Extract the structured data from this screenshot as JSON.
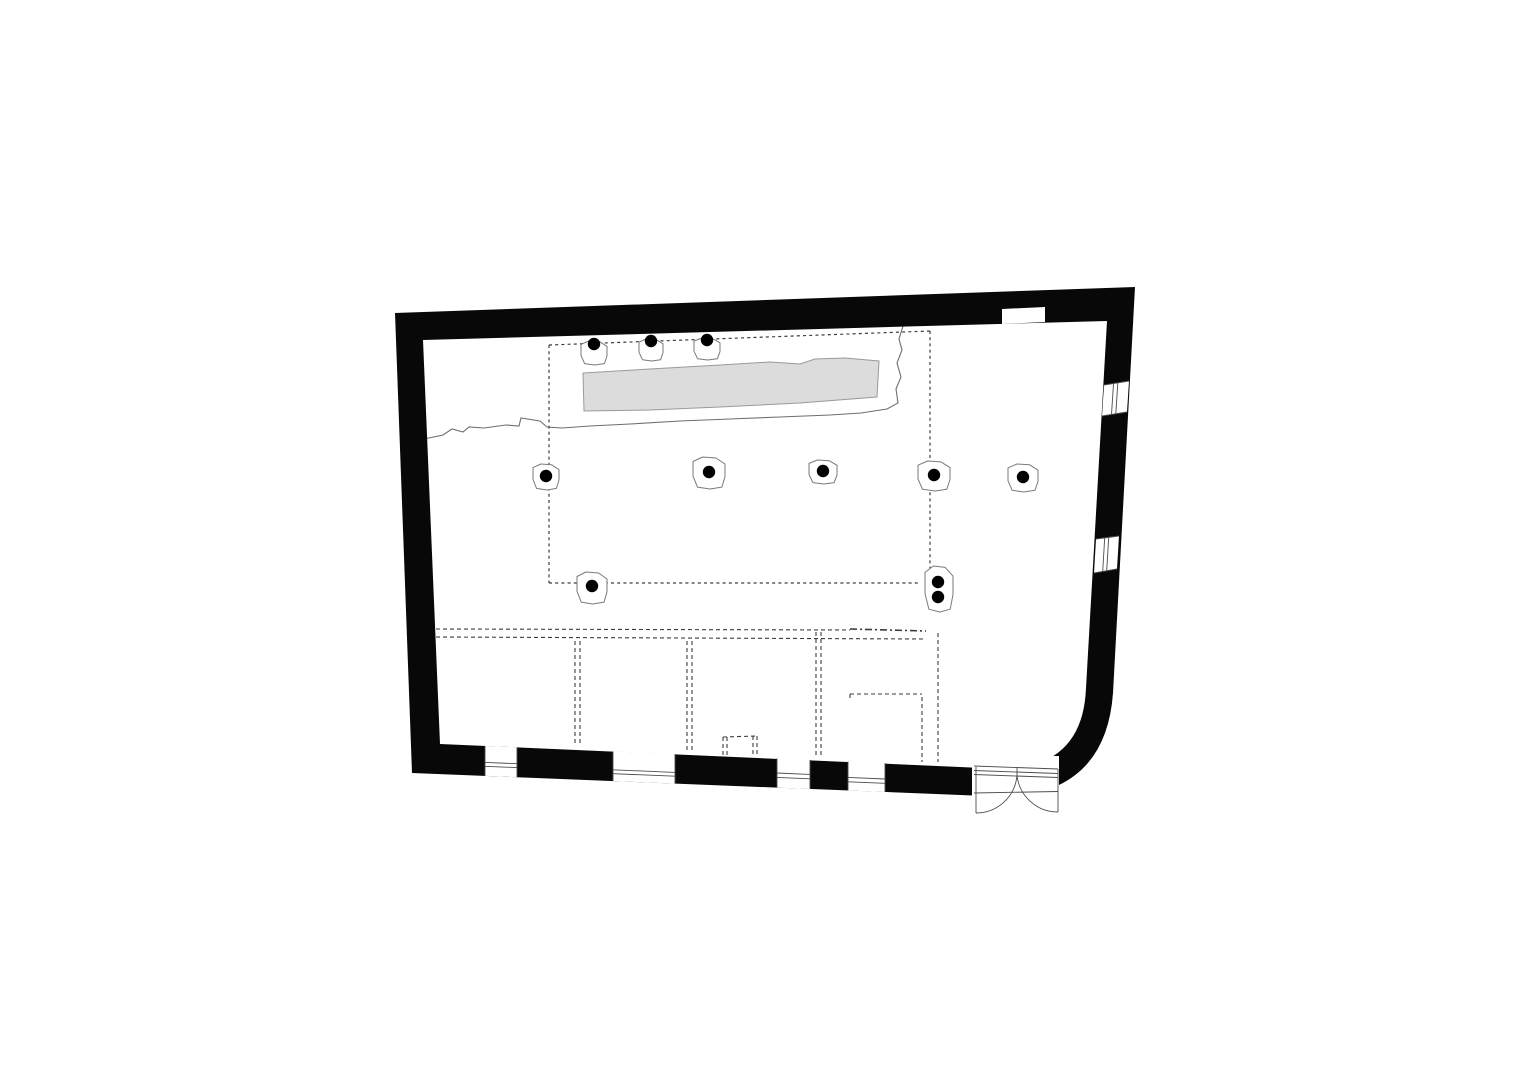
{
  "meta": {
    "kind": "architectural-floor-plan",
    "canvas": {
      "width": 1528,
      "height": 1080
    }
  },
  "colors": {
    "background": "#ffffff",
    "wall_fill": "#080808",
    "thin_line": "#4d4d4d",
    "survey_line": "#6e6e6e",
    "dash_line": "#3c3c3c",
    "paved_fill": "#dcdcdc",
    "paved_stroke": "#9a9a9a",
    "column_dot": "#000000",
    "column_base_stroke": "#7a7a7a",
    "column_base_fill": "#ffffff"
  },
  "walls": {
    "outer_path": "M395,313 L1135,287 L1113,693 Q1106,790 1010,797 L412,773 Z",
    "inner_path": "M423,340 L1107,321 L1086,688 Q1083,766 1005,769 L440,744 Z",
    "niche_poly": [
      [
        1002,
        309
      ],
      [
        1045,
        307
      ],
      [
        1045,
        322
      ],
      [
        1002,
        324
      ]
    ]
  },
  "openings": {
    "windows": [
      {
        "poly": [
          [
            485,
            745.9
          ],
          [
            517,
            747.3
          ],
          [
            517,
            777.2
          ],
          [
            485,
            775.9
          ]
        ],
        "lines": [
          [
            485,
            745.9,
            485,
            775.9
          ],
          [
            517,
            747.3,
            517,
            777.2
          ],
          [
            485,
            762.4,
            517,
            763.7
          ],
          [
            485,
            766.3,
            517,
            767.6
          ]
        ]
      },
      {
        "poly": [
          [
            613,
            751.4
          ],
          [
            675,
            754.1
          ],
          [
            675,
            783.6
          ],
          [
            613,
            781.1
          ]
        ],
        "lines": [
          [
            613,
            751.4,
            613,
            781.1
          ],
          [
            675,
            754.1,
            675,
            783.6
          ],
          [
            613,
            769.8,
            675,
            772.4
          ],
          [
            613,
            773.7,
            675,
            776.2
          ]
        ]
      },
      {
        "poly": [
          [
            777,
            758.4
          ],
          [
            810,
            759.9
          ],
          [
            810,
            789
          ],
          [
            777,
            787.6
          ]
        ],
        "lines": [
          [
            777,
            758.4,
            777,
            787.6
          ],
          [
            810,
            759.9,
            810,
            789
          ],
          [
            777,
            773,
            810,
            774.4
          ],
          [
            777,
            777.4,
            810,
            778.8
          ]
        ]
      },
      {
        "poly": [
          [
            848,
            761.5
          ],
          [
            885,
            763.1
          ],
          [
            885,
            792
          ],
          [
            848,
            790.5
          ]
        ],
        "lines": [
          [
            848,
            761.5,
            848,
            790.5
          ],
          [
            885,
            763.1,
            885,
            792
          ],
          [
            848,
            777.4,
            885,
            779
          ],
          [
            848,
            781.8,
            885,
            783.3
          ]
        ]
      },
      {
        "poly": [
          [
            1129,
            381
          ],
          [
            1104,
            385
          ],
          [
            1102,
            416
          ],
          [
            1127,
            412
          ]
        ],
        "lines": [
          [
            1129,
            381,
            1104,
            385
          ],
          [
            1127,
            412,
            1102,
            416
          ],
          [
            1117.8,
            382.8,
            1115.8,
            413.8
          ],
          [
            1113.5,
            383.5,
            1111.5,
            414.5
          ]
        ]
      },
      {
        "poly": [
          [
            1119,
            536
          ],
          [
            1096,
            539
          ],
          [
            1094,
            573
          ],
          [
            1117,
            569
          ]
        ],
        "lines": [
          [
            1119,
            536,
            1096,
            539
          ],
          [
            1117,
            569,
            1094,
            573
          ],
          [
            1108.7,
            537.4,
            1106.7,
            570.8
          ],
          [
            1104.7,
            537.9,
            1102.7,
            571.5
          ]
        ]
      }
    ],
    "door": {
      "poly": [
        [
          972,
          756
        ],
        [
          1059,
          756
        ],
        [
          1059,
          806
        ],
        [
          972,
          802
        ]
      ],
      "lines": [
        [
          974,
          766,
          1058,
          769
        ],
        [
          974,
          770.5,
          1058,
          773.5
        ],
        [
          974,
          774.5,
          1058,
          777.5
        ],
        [
          974,
          793,
          1058,
          791.5
        ],
        [
          976,
          767,
          976,
          813
        ],
        [
          1058,
          769,
          1058,
          812
        ],
        [
          1017,
          767,
          1017,
          775
        ]
      ],
      "swing_arcs": [
        "M1017,775 A41,41 0 0 1 976,813",
        "M1017,775 A41,41 0 0 0 1058,812"
      ]
    }
  },
  "interior": {
    "excavation_edge_path": "M424,439 L443,435 L452,429 L463,432 L469,427 L484,428 L506,425 L519,426 L521,418 L540,421 L547,427 L562,428 L590,426 L630,424 L680,421 L730,419 L780,417 L830,415 L861,413 L887,409 L898,403 L896,389 L901,377 L897,363 L902,350 L899,339 L903,326",
    "paved_strip_path": "M583,373 L650,369 L720,365 L770,362 L800,364 L815,359 L845,358 L879,361 L877,397 L800,403 L720,407 L650,410 L584,411 Z",
    "colonnade_dashes": [
      [
        549,
        345,
        549,
        583
      ],
      [
        549,
        345,
        930,
        331
      ],
      [
        930,
        331,
        930,
        576
      ],
      [
        549,
        583,
        920,
        583
      ]
    ],
    "room_trace_dashes": [
      [
        436,
        629,
        850,
        630
      ],
      [
        436,
        637,
        925,
        639
      ],
      [
        575,
        641,
        575,
        745
      ],
      [
        580,
        641,
        580,
        745
      ],
      [
        687,
        641,
        687,
        750
      ],
      [
        692,
        641,
        692,
        750
      ],
      [
        816,
        632,
        816,
        756
      ],
      [
        821,
        632,
        821,
        756
      ],
      [
        922,
        697,
        922,
        762
      ],
      [
        938,
        633,
        938,
        762
      ],
      [
        850,
        694,
        922,
        694
      ],
      [
        850,
        694,
        850,
        700
      ],
      [
        723,
        737,
        757,
        736
      ],
      [
        723,
        737,
        723,
        755
      ],
      [
        727,
        737,
        727,
        755
      ],
      [
        753,
        736,
        753,
        755
      ],
      [
        757,
        736,
        757,
        755
      ]
    ],
    "heavy_trace_dashes": [
      [
        850,
        629,
        926,
        631
      ]
    ]
  },
  "columns": {
    "dot_radius": 6.2,
    "base_unit_offsets": [
      [
        -0.5,
        -0.36
      ],
      [
        -0.2,
        -0.5
      ],
      [
        0.22,
        -0.47
      ],
      [
        0.5,
        -0.28
      ],
      [
        0.5,
        0.12
      ],
      [
        0.4,
        0.44
      ],
      [
        0.03,
        0.5
      ],
      [
        -0.36,
        0.44
      ],
      [
        -0.5,
        0.1
      ]
    ],
    "single": [
      {
        "x": 594,
        "y": 344,
        "w": 26,
        "h": 24,
        "dy": 9
      },
      {
        "x": 651,
        "y": 341,
        "w": 24,
        "h": 22,
        "dy": 9
      },
      {
        "x": 707,
        "y": 340,
        "w": 26,
        "h": 22,
        "dy": 9
      },
      {
        "x": 546,
        "y": 476,
        "w": 26,
        "h": 26,
        "dy": 1
      },
      {
        "x": 709,
        "y": 472,
        "w": 32,
        "h": 32,
        "dy": 1
      },
      {
        "x": 823,
        "y": 471,
        "w": 28,
        "h": 24,
        "dy": 1
      },
      {
        "x": 934,
        "y": 475,
        "w": 32,
        "h": 30,
        "dy": 1
      },
      {
        "x": 1023,
        "y": 477,
        "w": 30,
        "h": 28,
        "dy": 1
      },
      {
        "x": 592,
        "y": 586,
        "w": 30,
        "h": 32,
        "dy": 2
      }
    ],
    "double": {
      "base": {
        "x": 939,
        "y": 589,
        "w": 28,
        "h": 46
      },
      "dots": [
        [
          938,
          582
        ],
        [
          938,
          597
        ]
      ]
    }
  }
}
